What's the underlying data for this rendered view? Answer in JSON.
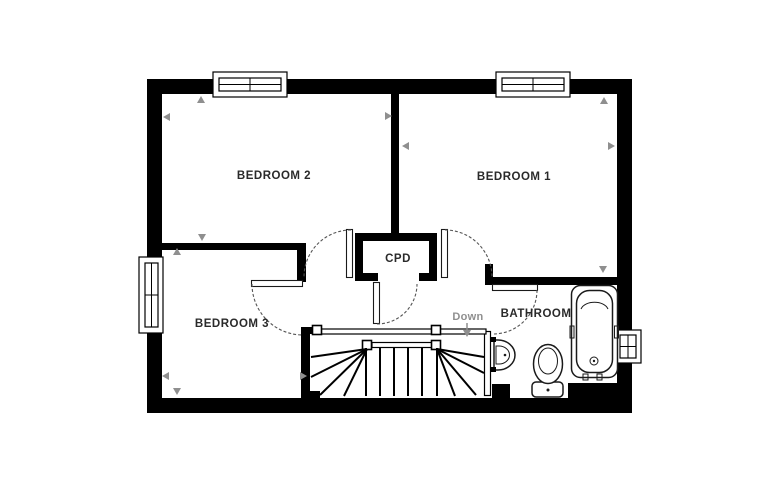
{
  "plan": {
    "rooms": {
      "bedroom1": "BEDROOM 1",
      "bedroom2": "BEDROOM 2",
      "bedroom3": "BEDROOM 3",
      "bathroom": "BATHROOM",
      "cupboard": "CPD"
    },
    "stairs": {
      "direction": "Down"
    },
    "fixtures": {
      "bath": "bath",
      "toilet": "toilet",
      "sink": "sink"
    },
    "colors": {
      "wall": "#000000",
      "line": "#1a1a1a",
      "dimension_arrow": "#8f8f8f",
      "down_label": "#8f8f8f",
      "background": "#ffffff"
    }
  }
}
